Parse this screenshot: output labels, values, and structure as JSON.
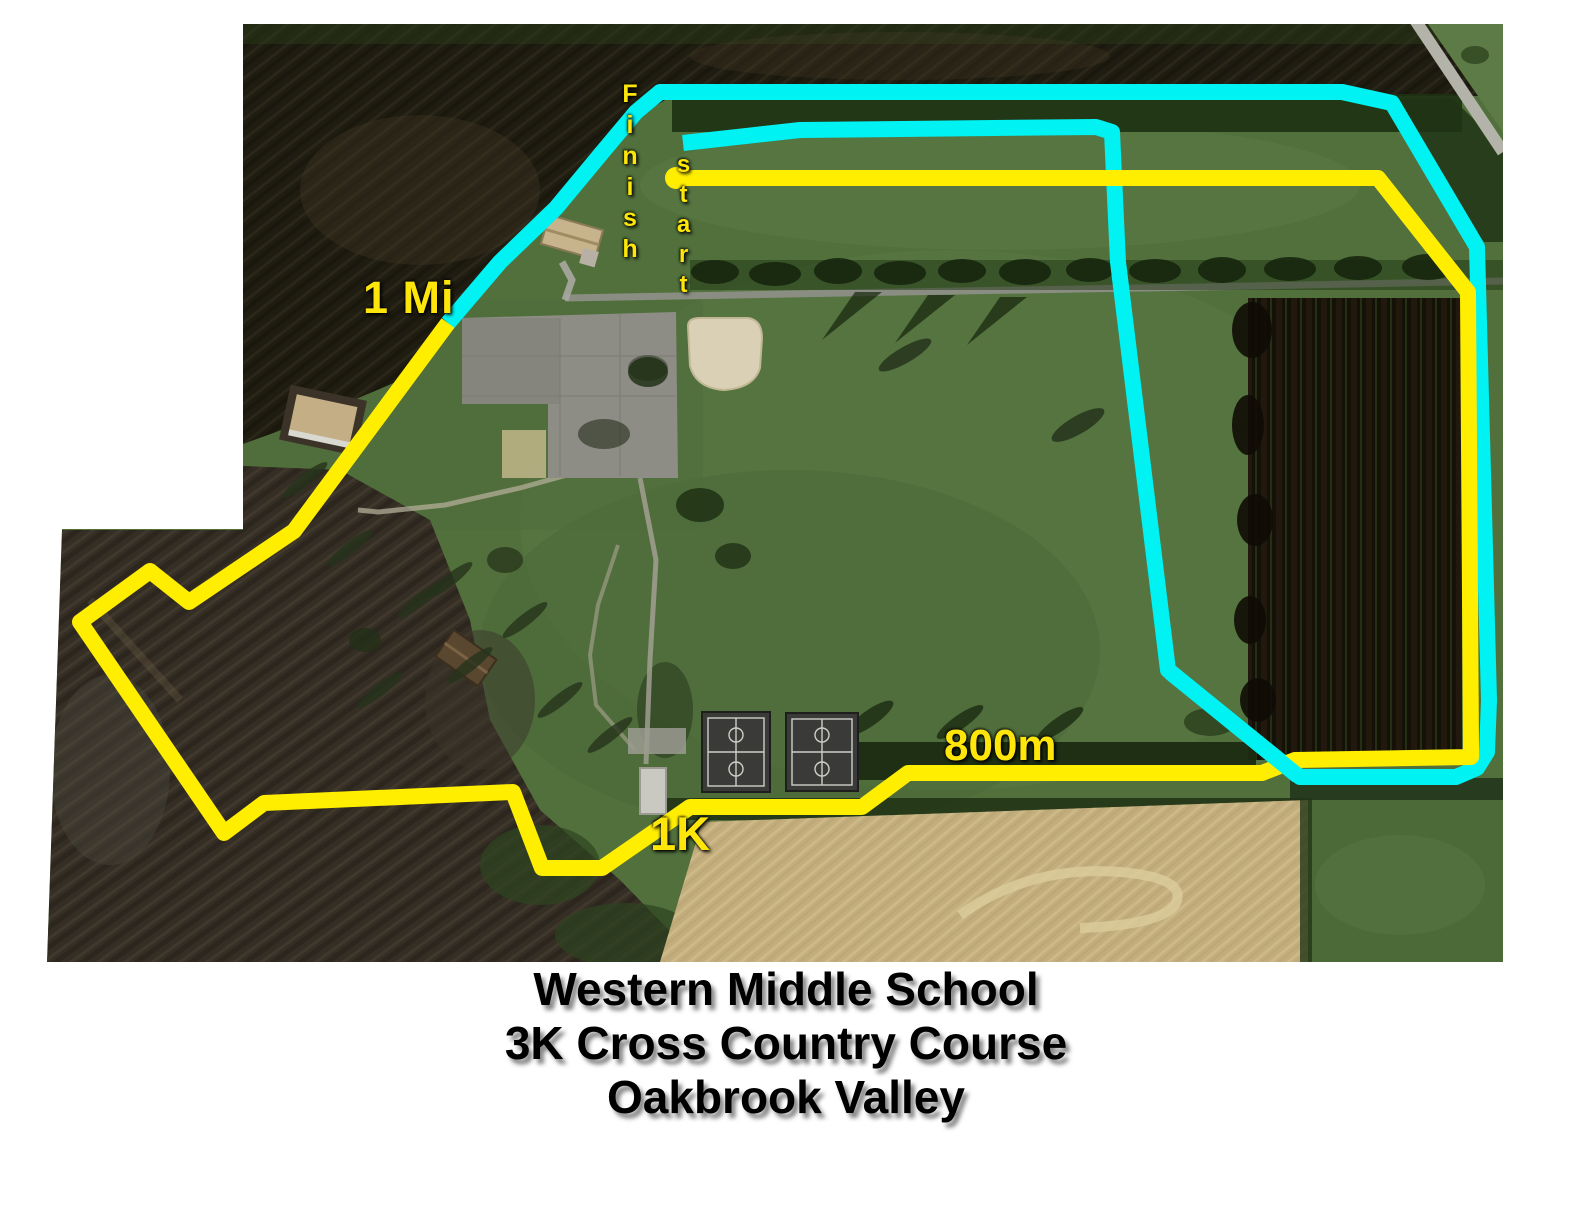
{
  "title": {
    "line1": "Western Middle School",
    "line2": "3K Cross Country Course",
    "line3": "Oakbrook Valley"
  },
  "map": {
    "labels": {
      "finish": "Finish",
      "start": "start",
      "one_mile": "1 Mi",
      "m800": "800m",
      "k1": "1K"
    },
    "colors": {
      "yellow": "#ffee00",
      "cyan": "#00f2f2",
      "label_yellow": "#ffe60a",
      "title_color": "#000000"
    },
    "course": {
      "stroke_width": 16,
      "yellow_path": [
        [
          676,
          178
        ],
        [
          1378,
          178
        ],
        [
          1468,
          292
        ],
        [
          1471,
          748
        ],
        [
          1471,
          757
        ],
        [
          1295,
          760
        ],
        [
          1262,
          773
        ],
        [
          908,
          773
        ],
        [
          862,
          807
        ],
        [
          690,
          807
        ],
        [
          602,
          868
        ],
        [
          542,
          868
        ],
        [
          513,
          792
        ],
        [
          264,
          803
        ],
        [
          224,
          833
        ],
        [
          80,
          622
        ],
        [
          150,
          571
        ],
        [
          189,
          602
        ],
        [
          294,
          531
        ],
        [
          448,
          323
        ]
      ],
      "cyan_path": [
        [
          448,
          323
        ],
        [
          500,
          262
        ],
        [
          556,
          208
        ],
        [
          600,
          155
        ],
        [
          636,
          112
        ],
        [
          660,
          92
        ],
        [
          1342,
          92
        ],
        [
          1392,
          103
        ],
        [
          1477,
          247
        ],
        [
          1489,
          700
        ],
        [
          1487,
          752
        ],
        [
          1477,
          768
        ],
        [
          1456,
          777
        ],
        [
          1300,
          777
        ],
        [
          1168,
          670
        ],
        [
          1118,
          262
        ],
        [
          1112,
          132
        ],
        [
          1096,
          127
        ],
        [
          800,
          130
        ],
        [
          683,
          143
        ]
      ],
      "cyan_overlay": [
        [
          1298,
          776
        ],
        [
          1170,
          672
        ]
      ],
      "start_dot": {
        "x": 676,
        "y": 178,
        "r": 11
      }
    }
  }
}
